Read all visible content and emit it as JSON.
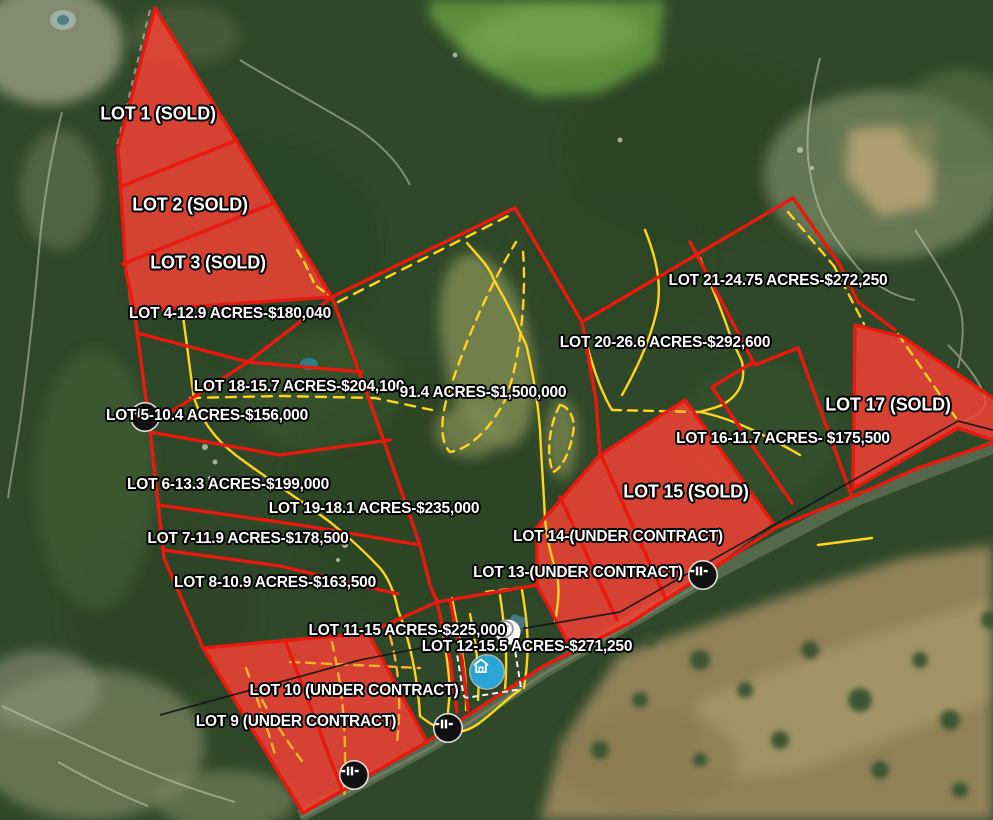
{
  "map_annotations": {
    "lots": [
      {
        "name": "LOT 1",
        "status": "SOLD",
        "label": "LOT 1 (SOLD)"
      },
      {
        "name": "LOT 2",
        "status": "SOLD",
        "label": "LOT 2 (SOLD)"
      },
      {
        "name": "LOT 3",
        "status": "SOLD",
        "label": "LOT 3 (SOLD)"
      },
      {
        "name": "LOT 4",
        "acres": "12.9",
        "price": "$180,040",
        "label": "LOT 4-12.9 ACRES-$180,040"
      },
      {
        "name": "LOT 5",
        "acres": "10.4",
        "price": "$156,000",
        "label": "LOT 5-10.4 ACRES-$156,000"
      },
      {
        "name": "LOT 6",
        "acres": "13.3",
        "price": "$199,000",
        "label": "LOT 6-13.3 ACRES-$199,000"
      },
      {
        "name": "LOT 7",
        "acres": "11.9",
        "price": "$178,500",
        "label": "LOT 7-11.9 ACRES-$178,500"
      },
      {
        "name": "LOT 8",
        "acres": "10.9",
        "price": "$163,500",
        "label": "LOT 8-10.9 ACRES-$163,500"
      },
      {
        "name": "LOT 9",
        "status": "UNDER CONTRACT",
        "label": "LOT 9 (UNDER CONTRACT)"
      },
      {
        "name": "LOT 10",
        "status": "UNDER CONTRACT",
        "label": "LOT 10 (UNDER CONTRACT)"
      },
      {
        "name": "LOT 11",
        "acres": "15",
        "price": "$225,000",
        "label": "LOT 11-15 ACRES-$225,000"
      },
      {
        "name": "LOT 12",
        "acres": "15.5",
        "price": "$271,250",
        "label": "LOT 12-15.5 ACRES-$271,250"
      },
      {
        "name": "LOT 13",
        "status": "UNDER CONTRACT",
        "label": "LOT 13-(UNDER CONTRACT)"
      },
      {
        "name": "LOT 14",
        "status": "UNDER CONTRACT",
        "label": "LOT 14-(UNDER CONTRACT)"
      },
      {
        "name": "LOT 15",
        "status": "SOLD",
        "label": "LOT 15 (SOLD)"
      },
      {
        "name": "LOT 16",
        "acres": "11.7",
        "price": "$175,500",
        "label": "LOT 16-11.7 ACRES- $175,500"
      },
      {
        "name": "LOT 17",
        "status": "SOLD",
        "label": "LOT 17 (SOLD)"
      },
      {
        "name": "LOT 18",
        "acres": "15.7",
        "price": "$204,100",
        "label": "LOT 18-15.7 ACRES-$204,100"
      },
      {
        "name": "LOT 19",
        "acres": "18.1",
        "price": "$235,000",
        "label": "LOT 19-18.1 ACRES-$235,000"
      },
      {
        "name": "LOT 20",
        "acres": "26.6",
        "price": "$292,600",
        "label": "LOT 20-26.6 ACRES-$292,600"
      },
      {
        "name": "LOT 21",
        "acres": "24.75",
        "price": "$272,250",
        "label": "LOT 21-24.75 ACRES-$272,250"
      }
    ],
    "remainder_tract": {
      "acres": "91.4",
      "price": "$1,500,000",
      "label": "91.4 ACRES-$1,500,000"
    },
    "markers": [
      {
        "type": "gate-marker"
      },
      {
        "type": "gate-marker"
      },
      {
        "type": "gate-marker"
      },
      {
        "type": "gate-marker"
      },
      {
        "type": "circle-t-marker"
      },
      {
        "type": "home-marker"
      },
      {
        "type": "faded-marker"
      }
    ],
    "colors": {
      "lot_fill_red": "#ff4136",
      "boundary_red": "#e8190f",
      "trail_yellow": "#ffd41f",
      "trail_orange": "#ffb030",
      "label_text": "#ffffff",
      "label_outline": "#000000",
      "home_marker_blue": "#2ba4d8",
      "gate_marker_black": "#101010"
    }
  }
}
